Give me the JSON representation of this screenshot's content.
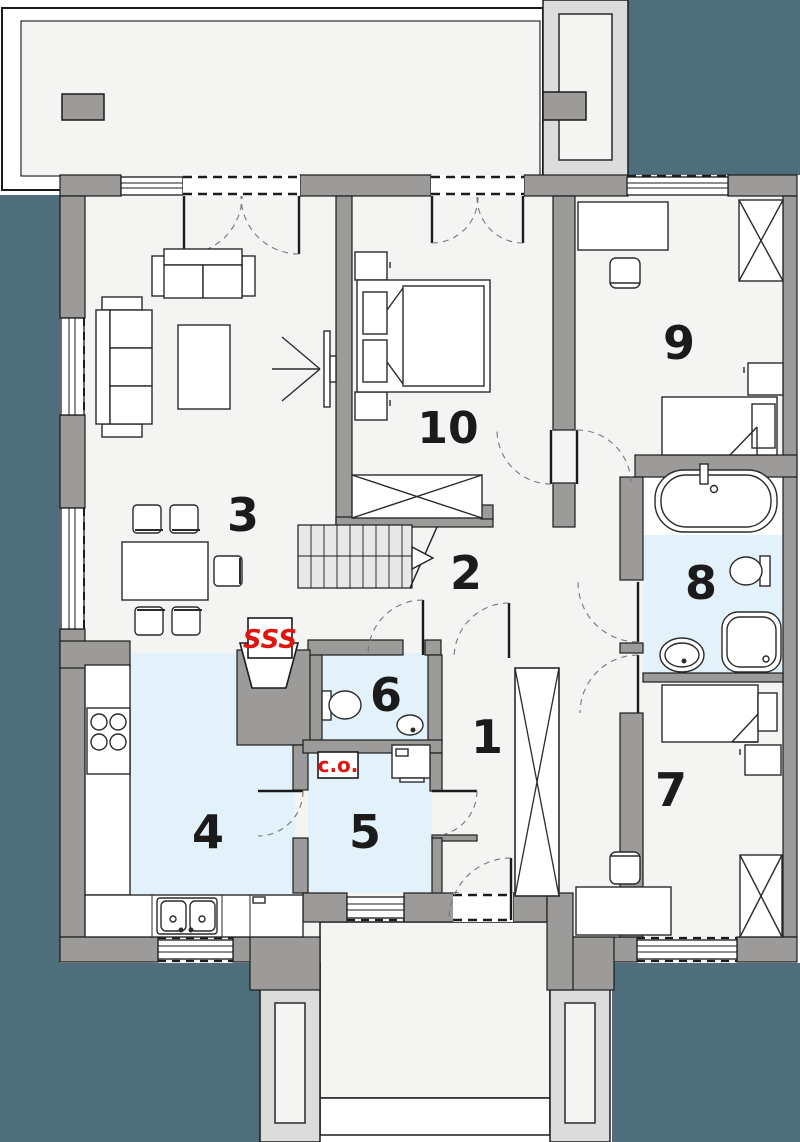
{
  "plan_title": "Parter - rzut kondygnacji",
  "colors": {
    "background_teal": "#4d6e7a",
    "wall_gray": "#9d9b99",
    "floor_light": "#f4f4f3",
    "wet_room_blue": "#e2f1fa",
    "porch_gray": "#dcdcdc",
    "accent_red": "#e0140e",
    "line_dark": "#1b1b1b"
  },
  "rooms": [
    {
      "label": "1"
    },
    {
      "label": "2"
    },
    {
      "label": "3"
    },
    {
      "label": "4"
    },
    {
      "label": "5"
    },
    {
      "label": "6"
    },
    {
      "label": "7"
    },
    {
      "label": "8"
    },
    {
      "label": "9"
    },
    {
      "label": "10"
    }
  ],
  "annotations": {
    "central_heating_label": "c.o.",
    "fireplace_heat_label": "SSS"
  }
}
